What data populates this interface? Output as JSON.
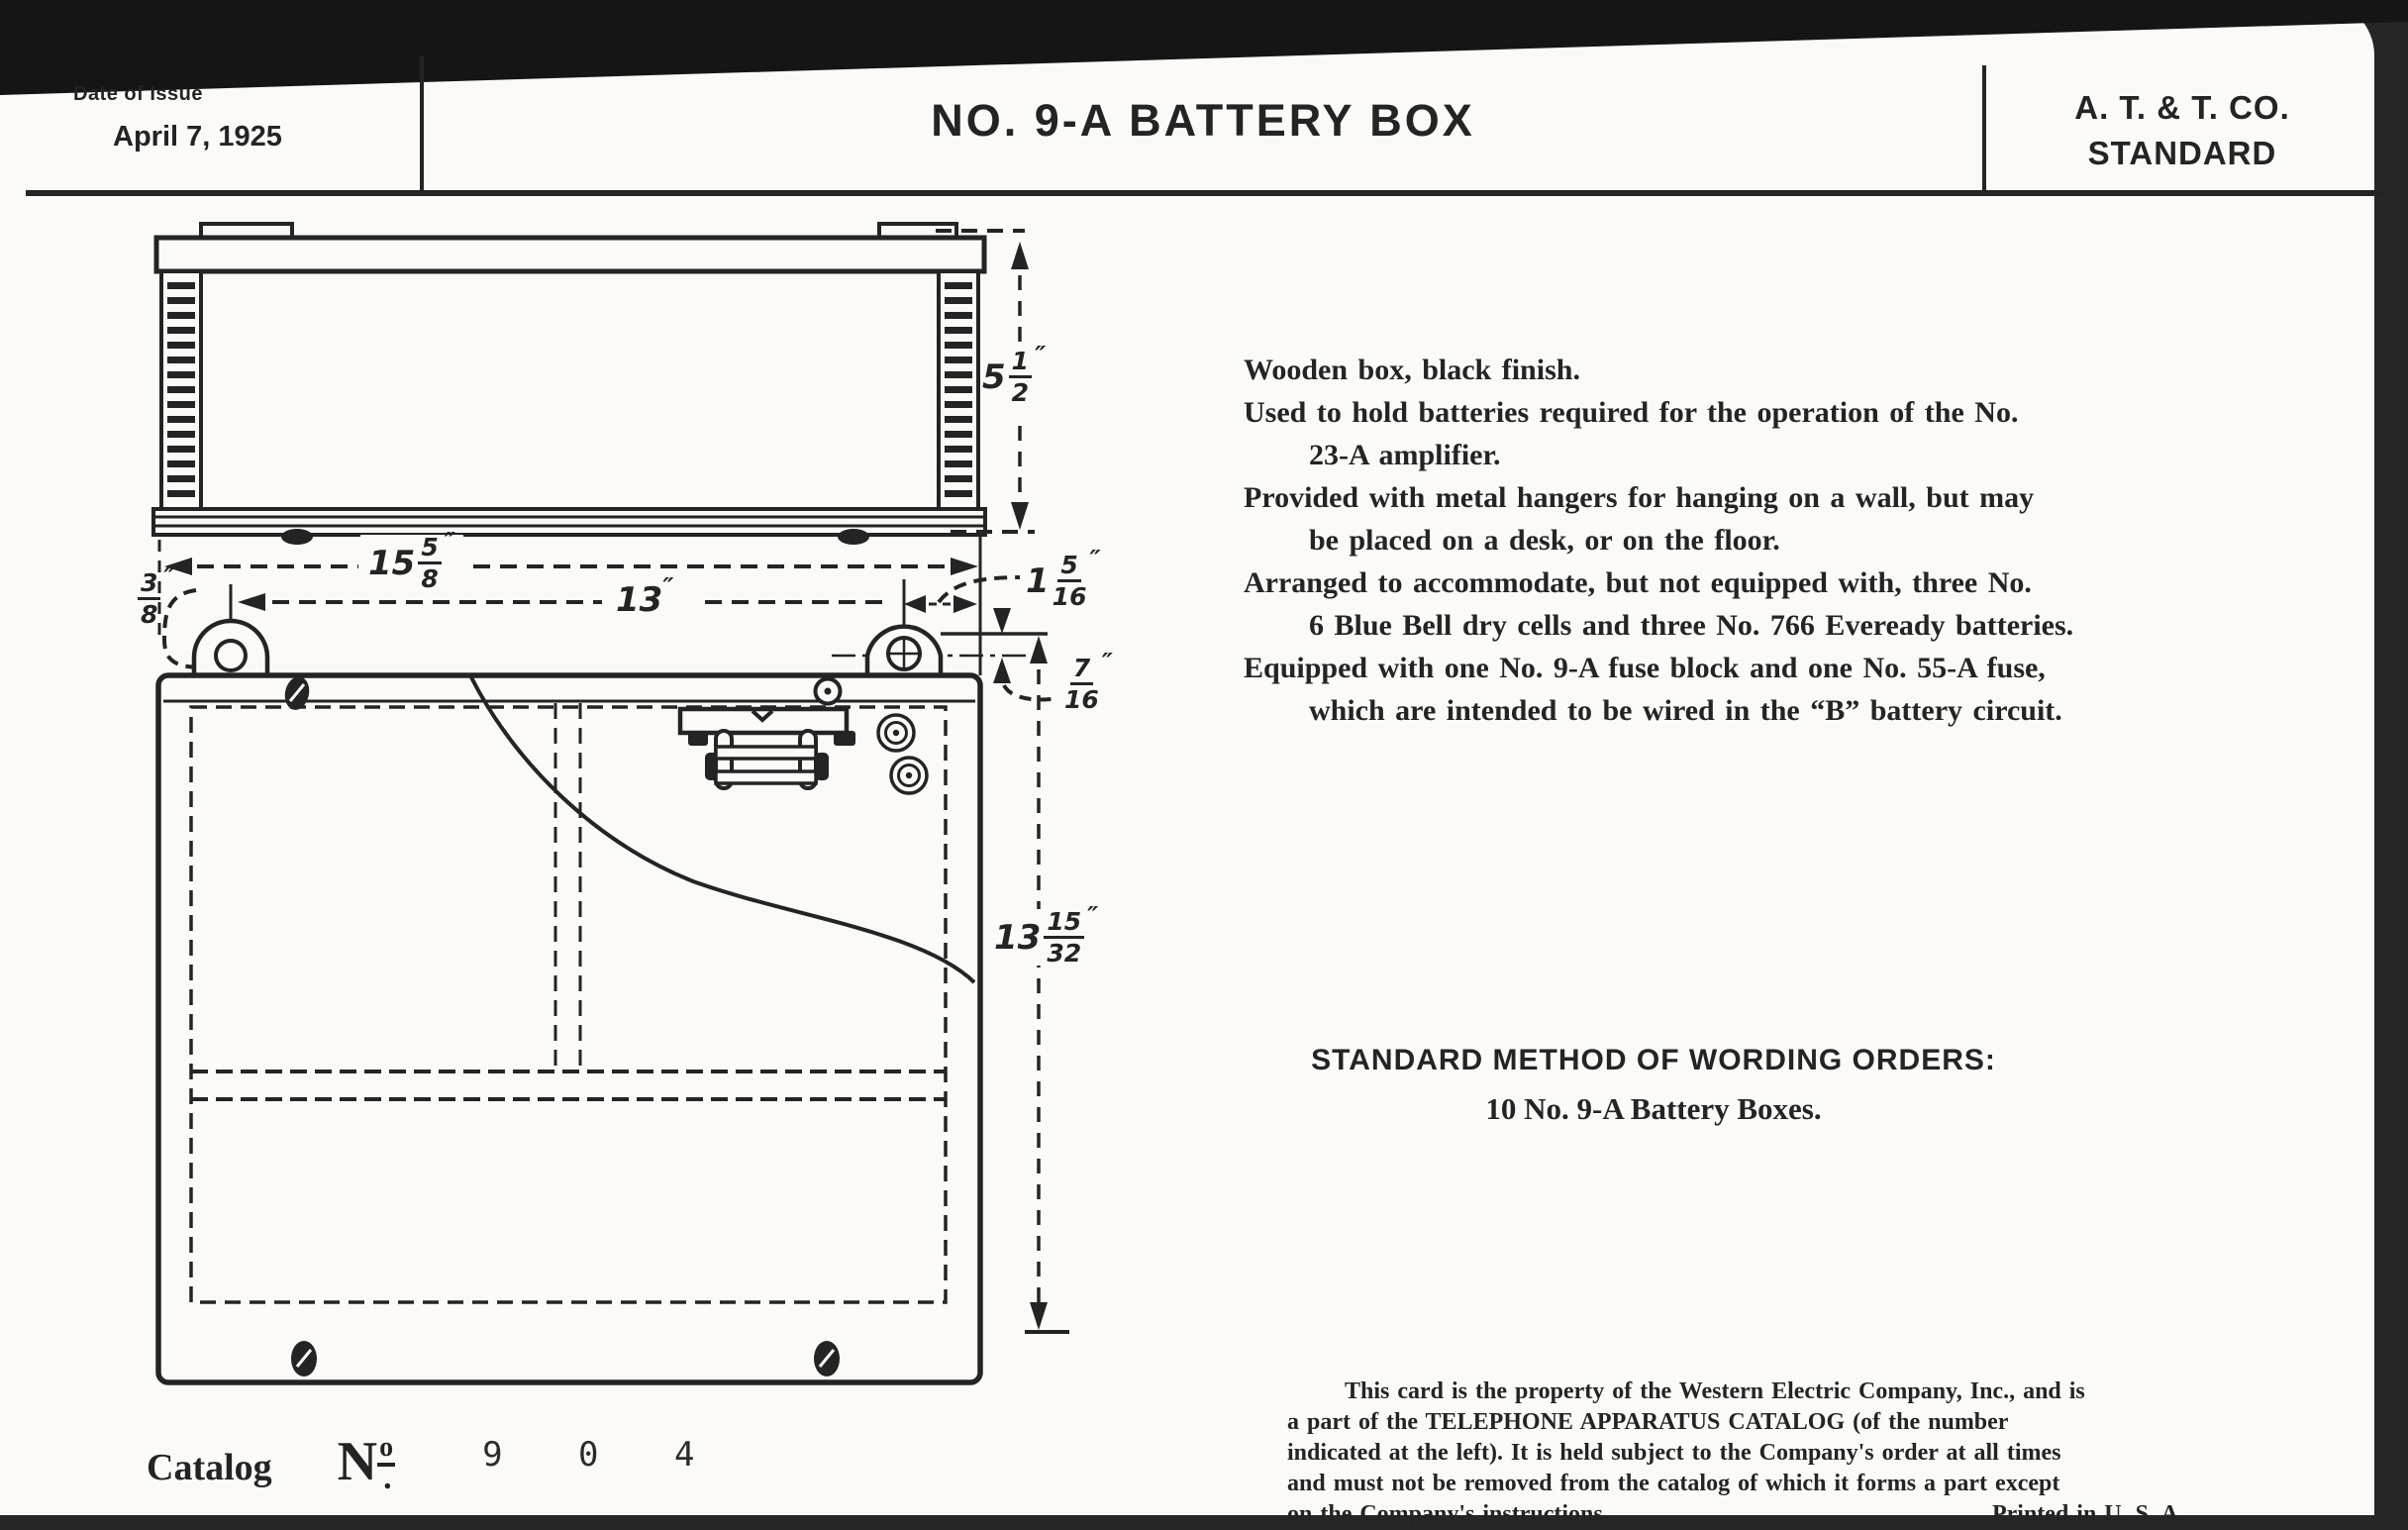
{
  "header": {
    "date_label": "Date of Issue",
    "date_value": "April 7, 1925",
    "title": "NO. 9-A BATTERY BOX",
    "org_line1": "A. T. & T. CO.",
    "org_line2": "STANDARD"
  },
  "description": {
    "lines": [
      {
        "text": "Wooden box, black finish."
      },
      {
        "text": "Used to hold batteries required for the operation of the No."
      },
      {
        "text": "23-A amplifier."
      },
      {
        "text": "Provided with metal hangers for hanging on a wall, but may"
      },
      {
        "text": "be placed on a desk, or on the floor."
      },
      {
        "text": "Arranged to accommodate, but not equipped with, three No."
      },
      {
        "text": "6 Blue Bell dry cells and three No. 766 Eveready batteries."
      },
      {
        "text": "Equipped with one No. 9-A fuse block and one No. 55-A fuse,"
      },
      {
        "text": "which are intended to be wired in the “B” battery circuit."
      }
    ]
  },
  "orders": {
    "heading": "STANDARD METHOD OF WORDING ORDERS:",
    "line": "10 No. 9-A Battery Boxes."
  },
  "fine_print": {
    "lines": [
      {
        "text": "This card is the property of the Western Electric Company, Inc., and is"
      },
      {
        "text": "a part of the TELEPHONE APPARATUS CATALOG (of the number"
      },
      {
        "text": "indicated at the left).  It is held subject to the Company's order at all times"
      },
      {
        "text": "and must not be removed from the catalog of which it forms a part except"
      }
    ],
    "footer_left": "on the Company's instructions.",
    "footer_right": "Printed in U. S. A."
  },
  "catalog": {
    "label": "Catalog",
    "no_n": "N",
    "no_o": "o",
    "no_dot": ".",
    "number": "9 0 4"
  },
  "drawing": {
    "dimensions": {
      "side_height": {
        "whole": "5",
        "num": "1",
        "den": "2",
        "unit": "″"
      },
      "overall_width": {
        "whole": "15",
        "num": "5",
        "den": "8",
        "unit": "″"
      },
      "hole_span": {
        "value": "13",
        "unit": "″"
      },
      "edge_offset": {
        "num": "3",
        "den": "8",
        "unit": "″"
      },
      "hole_offset": {
        "whole": "1",
        "num": "5",
        "den": "16",
        "unit": "″"
      },
      "hanger_drop": {
        "num": "7",
        "den": "16",
        "unit": "″"
      },
      "front_height": {
        "whole": "13",
        "num": "15",
        "den": "32",
        "unit": "″"
      }
    },
    "ink_color": "#242424",
    "paper_color": "#fbfaf7"
  }
}
